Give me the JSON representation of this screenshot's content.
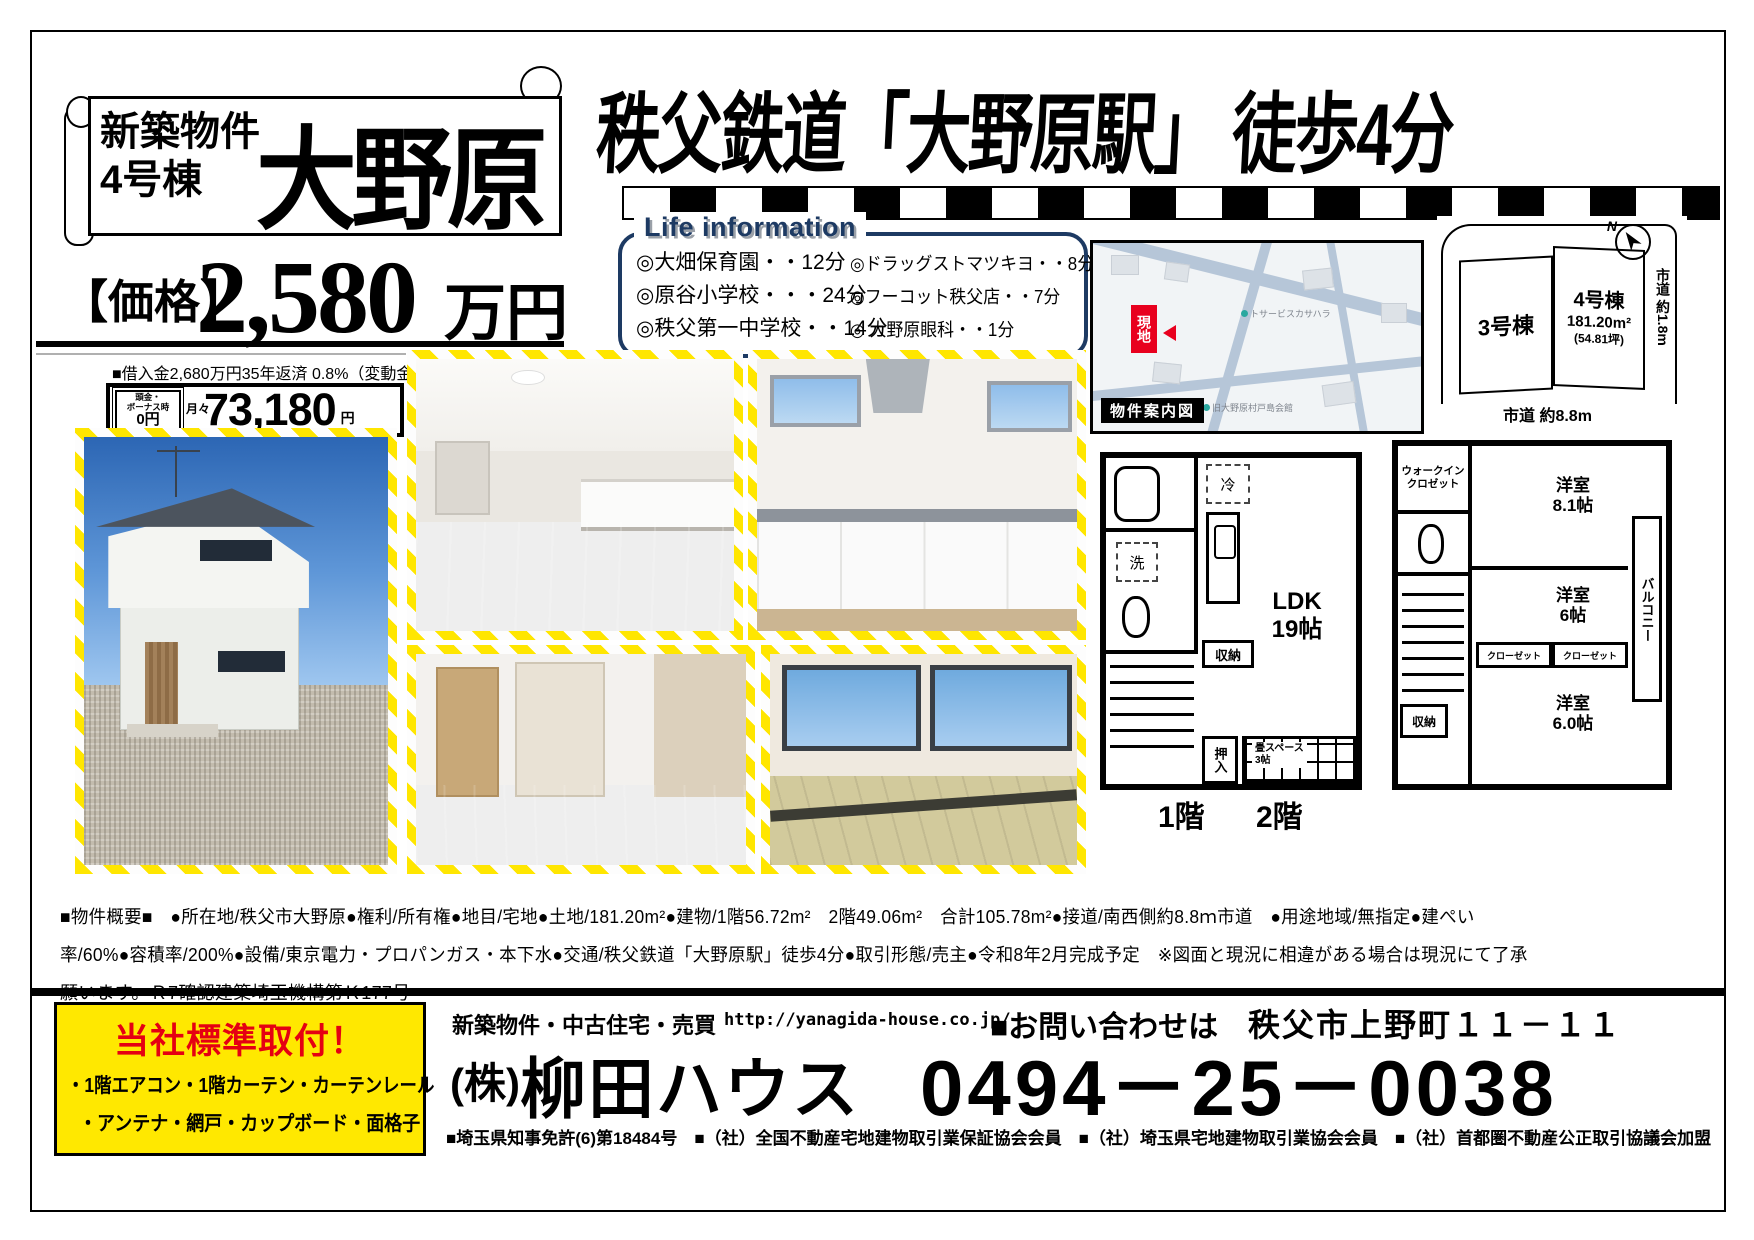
{
  "header": {
    "ribbon": {
      "sub1": "新築物件",
      "sub2": "4号棟",
      "name": "大野原"
    },
    "station": "秩父鉄道「大野原駅」 徒歩4分",
    "price_label": "【価格】",
    "price_value": "2,580",
    "price_unit": "万円",
    "loan_note": "■借入金2,680万円35年返済 0.8%（変動金利）■",
    "payment": {
      "deposit_label": "頭金・\nボーナス時",
      "deposit_value": "0円",
      "monthly_label": "月々",
      "amount": "73,180",
      "unit": "円"
    }
  },
  "life_info": {
    "title": "Life information",
    "left": [
      "◎大畑保育園・・12分",
      "◎原谷小学校・・・24分",
      "◎秩父第一中学校・・14分"
    ],
    "right": [
      "◎ドラッグストマツキヨ・・8分",
      "◎フーコット秩父店・・7分",
      "◎ 大野原眼科・・1分"
    ]
  },
  "map": {
    "caption": "物件案内図",
    "marker": "現地",
    "poi1": "トサービスカサハラ",
    "poi2": "旧大野原村戸島会館"
  },
  "site_plan": {
    "north": "N",
    "lot3": "3号棟",
    "lot4_name": "4号棟",
    "lot4_area": "181.20m²",
    "lot4_tsubo": "(54.81坪)",
    "road_right": "市道 約1.8m",
    "road_bottom": "市道 約8.8m"
  },
  "floor_plans": {
    "f1": {
      "caption": "1階",
      "fridge": "冷",
      "laundry": "洗",
      "storage": "収納",
      "ldk": "LDK\n19帖",
      "oshiire": "押入",
      "tatami": "畳スペース\n3帖"
    },
    "f2": {
      "caption": "2階",
      "wic": "ウォークイン\nクロゼット",
      "storage": "収納",
      "closet1": "クローゼット",
      "closet2": "クローゼット",
      "room1": "洋室\n8.1帖",
      "room2": "洋室\n6帖",
      "room3": "洋室\n6.0帖",
      "balcony": "バルコニー"
    }
  },
  "overview": {
    "line1": "■物件概要■　●所在地/秩父市大野原●権利/所有権●地目/宅地●土地/181.20m²●建物/1階56.72m²　2階49.06m²　合計105.78m²●接道/南西側約8.8ｍ市道　●用途地域/無指定●建ぺい",
    "line2": "率/60%●容積率/200%●設備/東京電力・プロパンガス・本下水●交通/秩父鉄道「大野原駅」徒歩4分●取引形態/売主●令和8年2月完成予定　※図面と現況に相違がある場合は現況にて了承",
    "line3": "願います。Ｒ7確認建築埼玉機構第Ｋ177号"
  },
  "footer": {
    "standard_title": "当社標準取付！",
    "standard_line1": "・1階エアコン・1階カーテン・カーテンレール",
    "standard_line2": "・アンテナ・網戸・カップボード・面格子",
    "services": "新築物件・中古住宅・売買",
    "url": "http://yanagida-house.co.jp/",
    "contact": "■お問い合わせは",
    "address": "秩父市上野町１１－１１",
    "company_prefix": "(株)",
    "company_name": "柳田ハウス",
    "phone": "0494－25－0038",
    "licenses": "■埼玉県知事免許(6)第18484号　■（社）全国不動産宅地建物取引業保証協会会員　■（社）埼玉県宅地建物取引業協会会員　■（社）首都圏不動産公正取引協議会加盟"
  }
}
